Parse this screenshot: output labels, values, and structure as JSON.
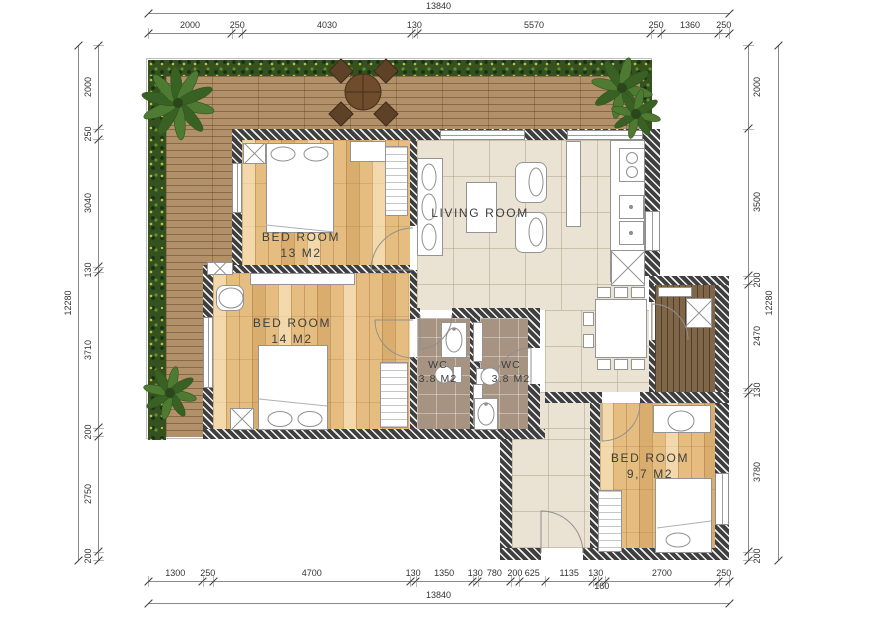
{
  "floor_plan": {
    "rooms": [
      {
        "name": "BED ROOM",
        "area": "13 M2"
      },
      {
        "name": "BED ROOM",
        "area": "14 M2"
      },
      {
        "name": "LIVING ROOM",
        "area": ""
      },
      {
        "name": "WC",
        "area": "3.8 M2"
      },
      {
        "name": "WC",
        "area": "3.8 M2"
      },
      {
        "name": "BED ROOM",
        "area": "9,7 M2"
      }
    ]
  },
  "dimensions": {
    "top": {
      "total": "13840",
      "segments": [
        "2000",
        "250",
        "4030",
        "130",
        "5570",
        "250",
        "1360",
        "250"
      ]
    },
    "bottom": {
      "total": "13840",
      "segments": [
        "1300",
        "250",
        "4700",
        "130",
        "1350",
        "130",
        "780",
        "200",
        "625",
        "1135",
        "130",
        "160",
        "2700",
        "250"
      ]
    },
    "left": {
      "total": "12280",
      "segments": [
        "2000",
        "250",
        "3040",
        "130",
        "3710",
        "200",
        "2750",
        "200"
      ]
    },
    "right": {
      "total": "12280",
      "segments": [
        "2000",
        "3500",
        "200",
        "2470",
        "130",
        "3780",
        "200"
      ]
    }
  },
  "colors": {
    "wall": "#3f3f3f",
    "wood_floor": "#e6bd80",
    "terrace_deck": "#b2916a",
    "balcony_deck": "#806649",
    "hedge_green": "#35511f",
    "living_tile": "#eae2d2",
    "wc_tile": "#a69381",
    "terrace_table_wood": "#5e4227",
    "label_text": "#3e3e3e",
    "dimension_text": "#333333"
  }
}
